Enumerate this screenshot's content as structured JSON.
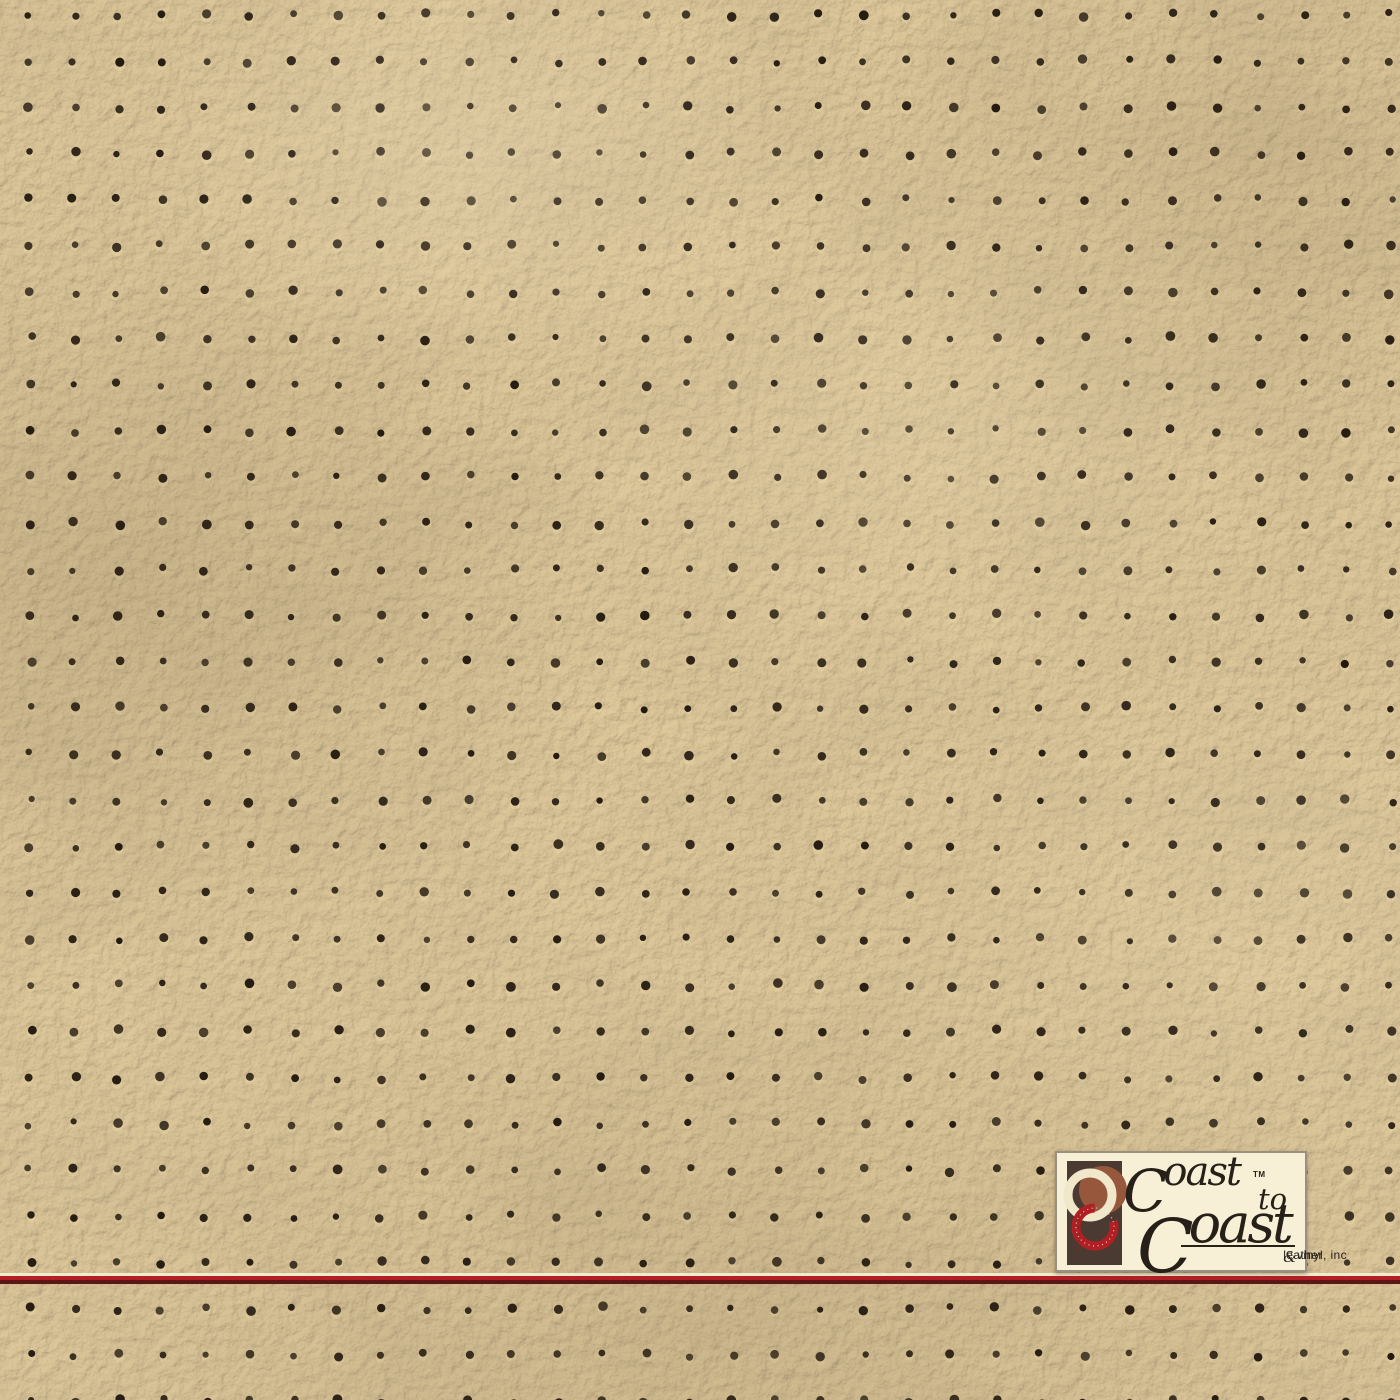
{
  "meta": {
    "description": "Beige perforated automotive leather / vinyl swatch with Coast to Coast brand plate",
    "width": 1400,
    "height": 1400
  },
  "brand": {
    "name_line1": "Coast",
    "trademark": "TM",
    "name_connector": "to",
    "name_line2": "Coast",
    "tagline_leather": "leather",
    "tagline_amp": "&",
    "tagline_vinyl": "vinyl, inc"
  },
  "palette": {
    "leather_base": "#c3aa7c",
    "leather_highlight": "#ecd7a9",
    "leather_shadow": "#8f7a52",
    "perforation_dot": "#241a10",
    "perforation_rim": "#e9d6a6",
    "stripe_cream": "#f2e9cf",
    "stripe_red": "#b22025",
    "stripe_maroon": "#5a1716",
    "logo_box_bg": "#f7f0d7",
    "logo_box_border": "#999180",
    "logo_text": "#262019",
    "mark_bg": "#4a3a31",
    "mark_cream": "#f1e8cc",
    "mark_rust": "#96573c",
    "mark_red": "#b01f23",
    "mark_stitch_dark": "#7a2b20"
  },
  "perforation": {
    "start_x": 30,
    "start_y": 15,
    "spacing_x": 43.9,
    "spacing_y": 46.2,
    "columns": 32,
    "rows": 31,
    "dot_radius": 3.9,
    "jitter": 2.5
  }
}
